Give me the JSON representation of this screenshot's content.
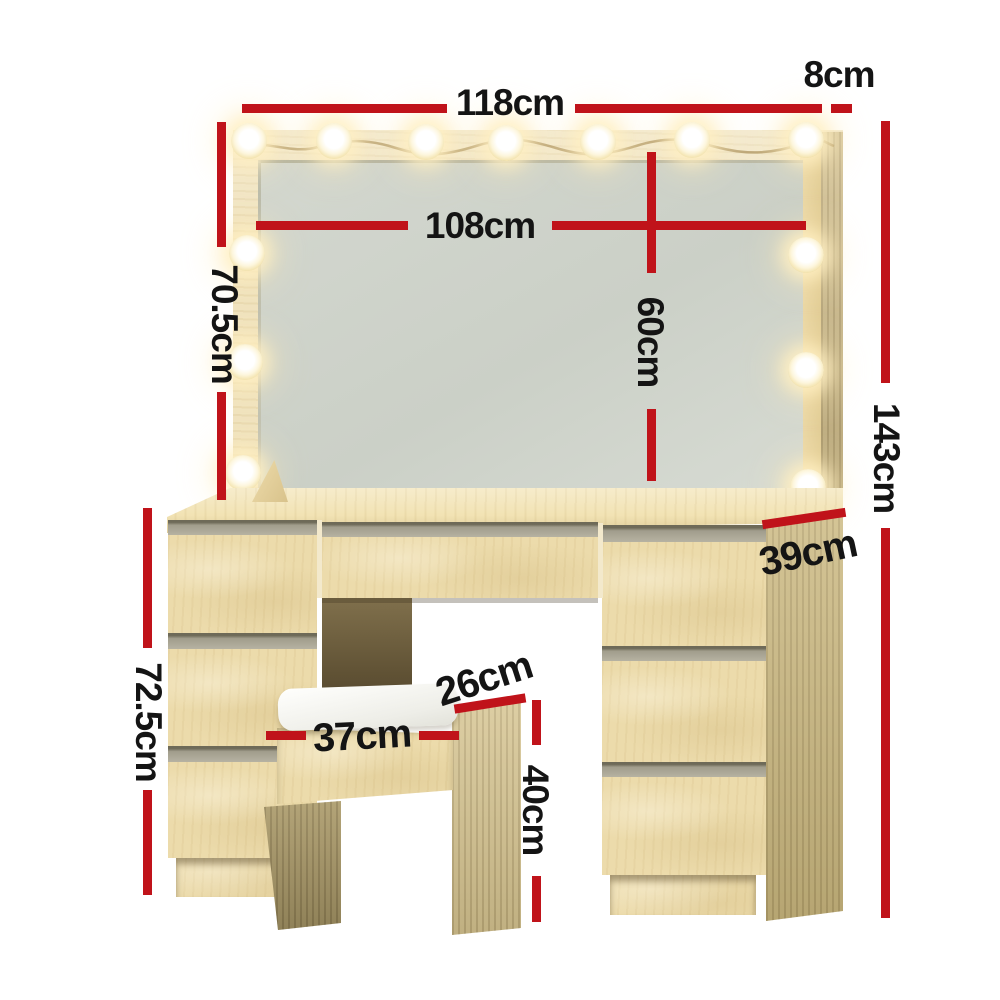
{
  "colors": {
    "dimension_line": "#c0131a",
    "label_text": "#141414",
    "background": "#ffffff"
  },
  "dimensions": [
    {
      "id": "overall-width",
      "label": "118cm"
    },
    {
      "id": "top-side-depth",
      "label": "8cm"
    },
    {
      "id": "mirror-width",
      "label": "108cm"
    },
    {
      "id": "mirror-height",
      "label": "70.5cm"
    },
    {
      "id": "mirror-inner-height",
      "label": "60cm"
    },
    {
      "id": "overall-height",
      "label": "143cm"
    },
    {
      "id": "table-depth",
      "label": "39cm"
    },
    {
      "id": "table-height",
      "label": "72.5cm"
    },
    {
      "id": "stool-depth",
      "label": "26cm"
    },
    {
      "id": "stool-width",
      "label": "37cm"
    },
    {
      "id": "stool-height",
      "label": "40cm"
    }
  ],
  "scene": {
    "bulb_count": 13,
    "drawer_count_left": 3,
    "drawer_count_right": 3,
    "center_drawer_count": 1
  }
}
